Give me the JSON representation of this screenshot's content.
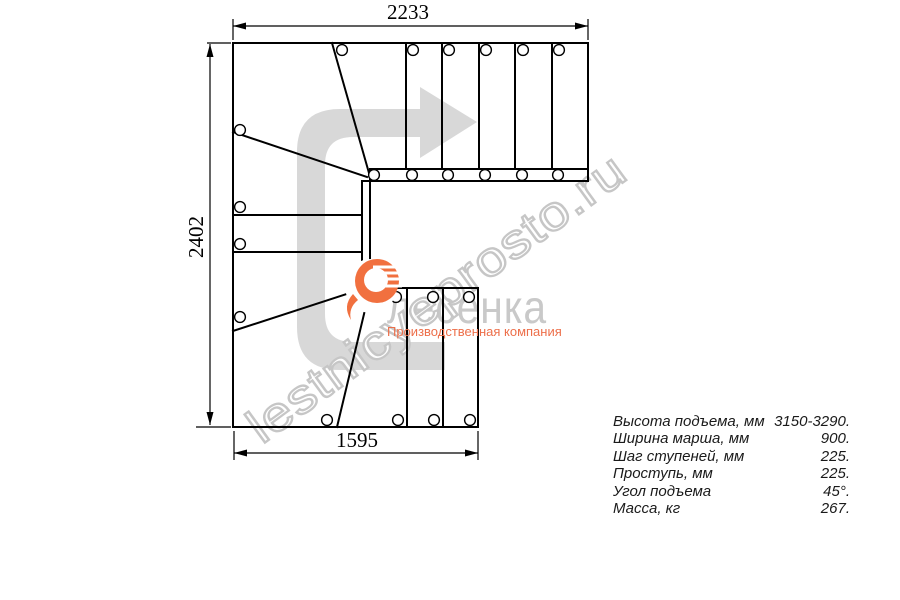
{
  "dimensions": {
    "top_mm": "2233",
    "left_mm": "2402",
    "bottom_mm": "1595"
  },
  "specs": [
    {
      "label": "Высота подъема, мм",
      "value": "3150-3290."
    },
    {
      "label": "Ширина марша, мм",
      "value": "900."
    },
    {
      "label": "Шаг ступеней, мм",
      "value": "225."
    },
    {
      "label": "Проступь, мм",
      "value": "225."
    },
    {
      "label": "Угол подъема",
      "value": "45°."
    },
    {
      "label": "Масса, кг",
      "value": "267."
    }
  ],
  "watermark": {
    "text": "lestnicyeprosto.ru",
    "color": "#c6c6c6"
  },
  "logo": {
    "wordmark": "лесенка",
    "subtitle": "Производственная компания",
    "orange": "#f1703f",
    "gray": "#c9c9c9"
  },
  "colors": {
    "line": "#000000",
    "arrow_fill": "#d8d8d8",
    "background": "#ffffff"
  },
  "drawing": {
    "plan_lines": [
      [
        233,
        43,
        588,
        43
      ],
      [
        233,
        43,
        233,
        427
      ],
      [
        233,
        427,
        478,
        427
      ],
      [
        588,
        43,
        588,
        181
      ],
      [
        370,
        169,
        588,
        169
      ],
      [
        362,
        181,
        588,
        181
      ],
      [
        362,
        181,
        362,
        288
      ],
      [
        370,
        169,
        370,
        288
      ],
      [
        370,
        288,
        478,
        288
      ],
      [
        478,
        288,
        478,
        427
      ],
      [
        406,
        43,
        406,
        169
      ],
      [
        442,
        43,
        442,
        169
      ],
      [
        479,
        43,
        479,
        169
      ],
      [
        515,
        43,
        515,
        169
      ],
      [
        552,
        43,
        552,
        169
      ],
      [
        332,
        43,
        369,
        173
      ],
      [
        233,
        132,
        367,
        177
      ],
      [
        233,
        215,
        362,
        215
      ],
      [
        233,
        252,
        362,
        252
      ],
      [
        233,
        331,
        362,
        289
      ],
      [
        370,
        289,
        337,
        427
      ],
      [
        407,
        288,
        407,
        427
      ],
      [
        443,
        288,
        443,
        427
      ]
    ],
    "fastener_circles": [
      [
        342,
        50
      ],
      [
        413,
        50
      ],
      [
        449,
        50
      ],
      [
        486,
        50
      ],
      [
        523,
        50
      ],
      [
        559,
        50
      ],
      [
        374,
        175
      ],
      [
        412,
        175
      ],
      [
        448,
        175
      ],
      [
        485,
        175
      ],
      [
        522,
        175
      ],
      [
        558,
        175
      ],
      [
        240,
        130
      ],
      [
        240,
        207
      ],
      [
        240,
        244
      ],
      [
        240,
        317
      ],
      [
        396,
        297
      ],
      [
        433,
        297
      ],
      [
        469,
        297
      ],
      [
        327,
        420
      ],
      [
        398,
        420
      ],
      [
        434,
        420
      ],
      [
        470,
        420
      ]
    ],
    "travel_arrow_path": "M445,342 L353,342 Q325,342 325,314 L325,165 Q325,137 353,137 L420,137 L420,158 L477,122 L420,87 L420,109 L340,109 Q297,109 297,152 L297,327 Q297,370 340,370 L445,370 Z",
    "dim_lines": [
      [
        233,
        26,
        588,
        26
      ],
      [
        210,
        44,
        210,
        425
      ],
      [
        234,
        453,
        478,
        453
      ]
    ],
    "dim_extension_lines": [
      [
        233,
        40,
        233,
        19
      ],
      [
        588,
        40,
        588,
        19
      ],
      [
        207,
        43,
        231,
        43
      ],
      [
        196,
        427,
        231,
        427
      ],
      [
        234,
        431,
        234,
        460
      ],
      [
        478,
        431,
        478,
        460
      ]
    ],
    "dim_arrowheads": [
      [
        233,
        26,
        "left"
      ],
      [
        588,
        26,
        "right"
      ],
      [
        210,
        44,
        "up"
      ],
      [
        210,
        425,
        "down"
      ],
      [
        234,
        453,
        "left"
      ],
      [
        478,
        453,
        "right"
      ]
    ]
  }
}
